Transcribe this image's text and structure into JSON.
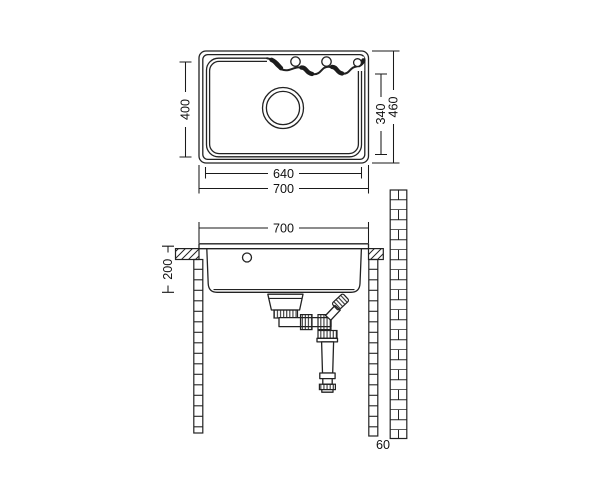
{
  "drawing": {
    "type": "kitchen-sink-technical-drawing",
    "views": [
      "top-view",
      "front-section-view"
    ],
    "colors": {
      "background": "#ffffff",
      "line": "#222222",
      "dim_text": "#111111"
    }
  },
  "labels": {
    "top_view": {
      "bowl_depth_side": "400",
      "overall_depth": "460",
      "front_apron_depth": "340",
      "bowl_width": "640",
      "overall_width": "700"
    },
    "front_view": {
      "overall_width": "700",
      "bowl_height": "200",
      "wall_offset": "60"
    }
  }
}
